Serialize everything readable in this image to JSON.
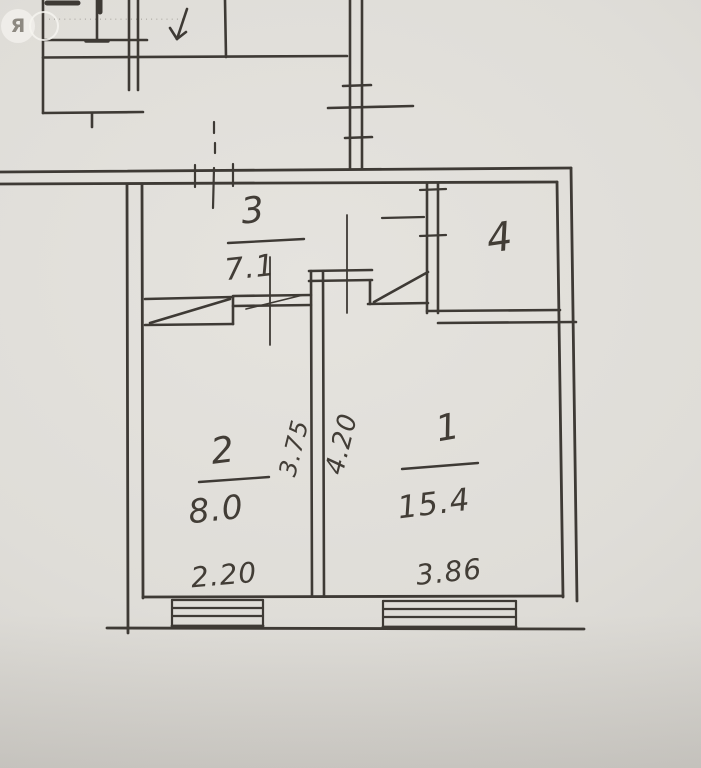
{
  "watermark": {
    "logo_letter": "Я",
    "dots_text": "········································"
  },
  "rooms": {
    "room3": {
      "number": "3",
      "area": "7.1"
    },
    "room4": {
      "number": "4"
    },
    "room2": {
      "number": "2",
      "area": "8.0"
    },
    "room1": {
      "number": "1",
      "area": "15.4"
    }
  },
  "dimensions": {
    "bottom_left": "2.20",
    "bottom_right": "3.86",
    "vertical_left": "3.75",
    "vertical_right": "4.20"
  }
}
